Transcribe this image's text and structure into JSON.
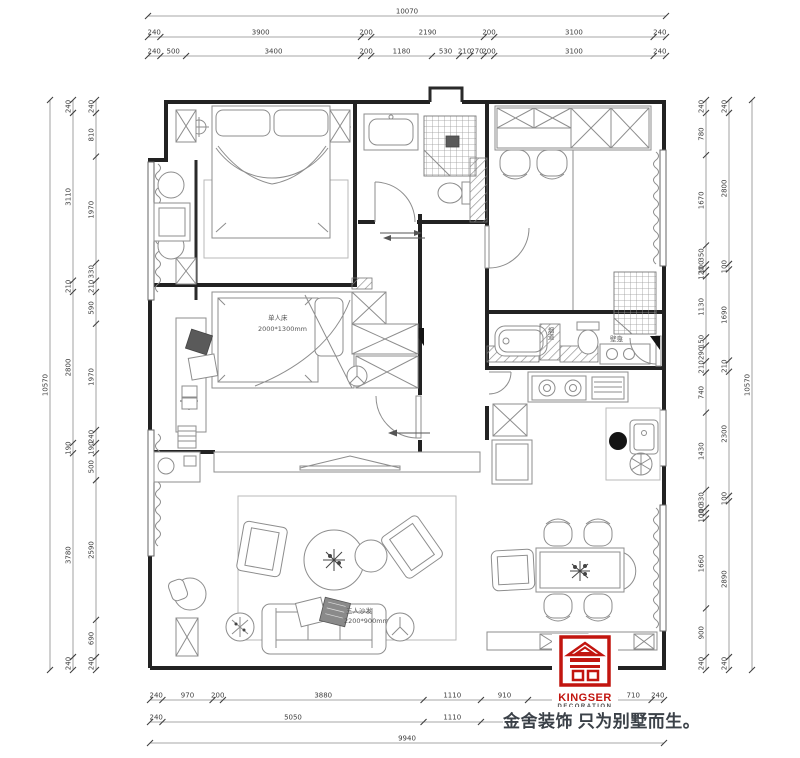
{
  "branding": {
    "brand": "KINGSER",
    "brand_sub": "DECORATION",
    "tagline": "金舍装饰 只为别墅而生。",
    "logo_color": "#c2150f"
  },
  "plan_labels": {
    "single_bed_line1": "单人床",
    "single_bed_line2": "2000*1300mm",
    "sofa_line1": "三人沙发",
    "sofa_line2": "2200*900mm",
    "niche": "壁龛",
    "flue": "烟道"
  },
  "colors": {
    "wall": "#222222",
    "furniture": "#8d8d8d",
    "dim_text": "#3d3d3d",
    "logo_red": "#c2150f"
  },
  "dimensions": {
    "chains": [
      {
        "id": "top-overall",
        "axis": "h",
        "pos": 16,
        "from": 148,
        "to": 666,
        "segs": [
          {
            "n": 10070
          }
        ]
      },
      {
        "id": "top-row2",
        "axis": "h",
        "pos": 37,
        "from": 148,
        "to": 666,
        "segs": [
          240,
          3900,
          200,
          2190,
          200,
          3100,
          240
        ]
      },
      {
        "id": "top-row3",
        "axis": "h",
        "pos": 56,
        "from": 148,
        "to": 666,
        "segs": [
          240,
          500,
          3400,
          200,
          1180,
          530,
          210,
          270,
          200,
          3100,
          240
        ]
      },
      {
        "id": "bottom-row1",
        "axis": "h",
        "pos": 700,
        "from": 150,
        "to": 664,
        "segs": [
          240,
          970,
          200,
          3880,
          1110,
          910,
          {
            "n": 1680,
            "t": ""
          },
          710,
          240
        ]
      },
      {
        "id": "bottom-row2",
        "axis": "h",
        "pos": 722,
        "from": 150,
        "to": 664,
        "segs": [
          240,
          5050,
          1110,
          {
            "n": 3300,
            "t": ""
          },
          240
        ]
      },
      {
        "id": "bottom-overall",
        "axis": "h",
        "pos": 743,
        "from": 150,
        "to": 664,
        "segs": [
          {
            "n": 9940
          }
        ]
      },
      {
        "id": "left-overall",
        "axis": "v",
        "pos": 50,
        "from": 100,
        "to": 670,
        "segs": [
          {
            "n": 10570
          }
        ]
      },
      {
        "id": "left-col2",
        "axis": "v",
        "pos": 73,
        "from": 100,
        "to": 670,
        "segs": [
          240,
          3110,
          210,
          2800,
          190,
          3780,
          240
        ]
      },
      {
        "id": "left-col3",
        "axis": "v",
        "pos": 96,
        "from": 100,
        "to": 670,
        "segs": [
          240,
          810,
          1970,
          330,
          210,
          590,
          1970,
          240,
          190,
          500,
          2590,
          690,
          240
        ]
      },
      {
        "id": "right-col1",
        "axis": "v",
        "pos": 706,
        "from": 100,
        "to": 670,
        "segs": [
          240,
          780,
          1670,
          350,
          100,
          120,
          1130,
          150,
          290,
          210,
          740,
          1430,
          330,
          100,
          100,
          1660,
          900,
          240
        ]
      },
      {
        "id": "right-col2",
        "axis": "v",
        "pos": 729,
        "from": 100,
        "to": 670,
        "segs": [
          240,
          2800,
          100,
          1690,
          210,
          2300,
          100,
          2890,
          240
        ]
      },
      {
        "id": "right-overall",
        "axis": "v",
        "pos": 752,
        "from": 100,
        "to": 670,
        "segs": [
          {
            "n": 10570
          }
        ]
      }
    ]
  }
}
